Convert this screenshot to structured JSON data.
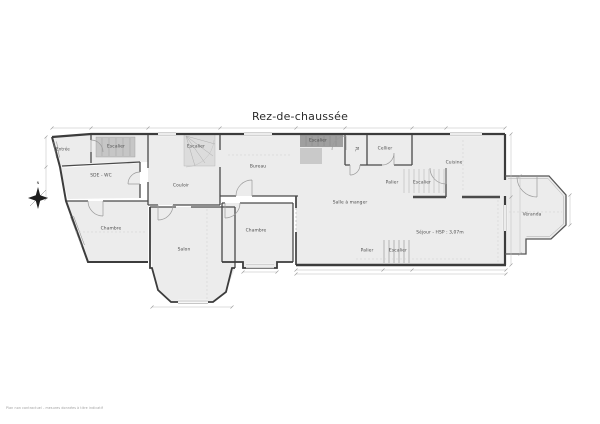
{
  "title": "Rez-de-chaussée",
  "compass": {
    "label": "N"
  },
  "fine_print": "Plan non contractuel - mesures données à titre indicatif",
  "rooms": [
    {
      "name": "Entrée"
    },
    {
      "name": "Escalier"
    },
    {
      "name": "SDE - WC"
    },
    {
      "name": "Escalier"
    },
    {
      "name": "Couloir"
    },
    {
      "name": "Bureau"
    },
    {
      "name": "Escalier"
    },
    {
      "name": "PL"
    },
    {
      "name": "Cellier"
    },
    {
      "name": "Palier"
    },
    {
      "name": "Escalier"
    },
    {
      "name": "Cuisine"
    },
    {
      "name": "Salle à manger"
    },
    {
      "name": "Séjour - HSP : 3,07m"
    },
    {
      "name": "Palier"
    },
    {
      "name": "Escalier"
    },
    {
      "name": "Chambre"
    },
    {
      "name": "Salon"
    },
    {
      "name": "Chambre"
    },
    {
      "name": "Véranda"
    }
  ],
  "colors": {
    "wall": "#3c3c3c",
    "floor": "#ececec",
    "stair_dark": "#9f9f9f",
    "stair_light": "#c9c9c9",
    "label": "#4c4c4c"
  }
}
